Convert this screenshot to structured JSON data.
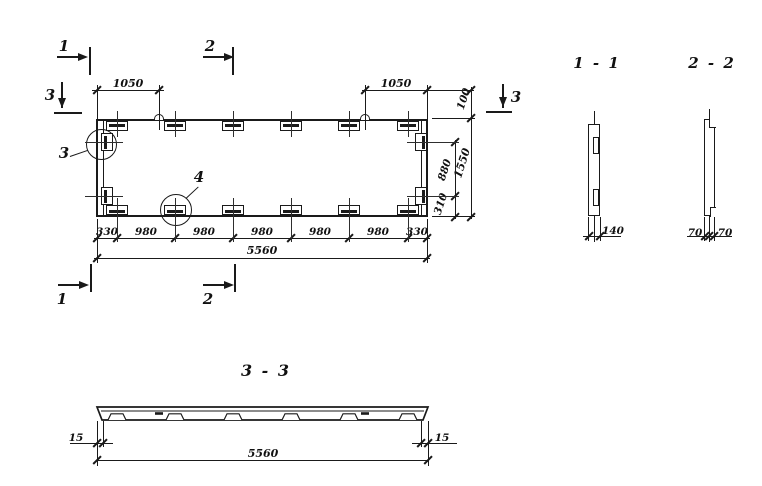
{
  "plan": {
    "markers": {
      "top_1": "1",
      "top_2": "2",
      "left_3": "3",
      "right_3": "3",
      "bottom_1": "1",
      "bottom_2": "2"
    },
    "details": {
      "circle_3": "3",
      "circle_4": "4"
    },
    "dims": {
      "top_left": "1050",
      "top_right": "1050",
      "right_100": "100",
      "right_880": "880",
      "right_310": "310",
      "right_overall": "1550",
      "bottom_chain": [
        "330",
        "980",
        "980",
        "980",
        "980",
        "980",
        "330"
      ],
      "bottom_overall": "5560"
    }
  },
  "section_1_1": {
    "title": "1 - 1",
    "dim_140": "140"
  },
  "section_2_2": {
    "title": "2 - 2",
    "dim_70_left": "70",
    "dim_70_right": "70"
  },
  "section_3_3": {
    "title": "3 - 3",
    "dim_15_left": "15",
    "dim_15_right": "15",
    "dim_overall": "5560"
  }
}
